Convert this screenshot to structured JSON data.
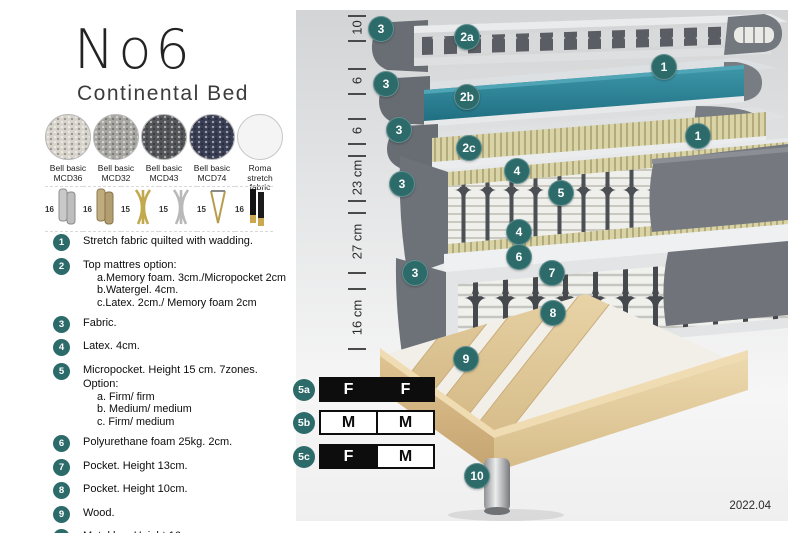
{
  "title": "No6",
  "subtitle": "Continental Bed",
  "accent": "#2d6b6b",
  "fabrics": [
    {
      "name": "Bell basic",
      "code": "MCD36",
      "color": "#d8d4cc"
    },
    {
      "name": "Bell basic",
      "code": "MCD32",
      "color": "#a7a6a1"
    },
    {
      "name": "Bell basic",
      "code": "MCD43",
      "color": "#55565a"
    },
    {
      "name": "Bell basic",
      "code": "MCD74",
      "color": "#3a3e55"
    },
    {
      "name": "Roma",
      "code": "stretch fabric",
      "color": "#f4f4f4"
    }
  ],
  "legs": [
    {
      "height": "16",
      "type": "cylinder-silver"
    },
    {
      "height": "16",
      "type": "cylinder-bronze"
    },
    {
      "height": "15",
      "type": "twist-gold"
    },
    {
      "height": "15",
      "type": "twist-silver"
    },
    {
      "height": "15",
      "type": "hairpin-gold"
    },
    {
      "height": "16",
      "type": "taper-black-gold"
    }
  ],
  "legend": [
    {
      "num": "1",
      "text": "Stretch fabric quilted with wadding.",
      "sub": []
    },
    {
      "num": "2",
      "text": "Top mattres option:",
      "sub": [
        "a.Memory foam. 3cm./Micropocket 2cm",
        "b.Watergel. 4cm.",
        "c.Latex. 2cm./ Memory foam 2cm"
      ]
    },
    {
      "num": "3",
      "text": "Fabric.",
      "sub": []
    },
    {
      "num": "4",
      "text": "Latex. 4cm.",
      "sub": []
    },
    {
      "num": "5",
      "text": "Micropocket. Height 15 cm. 7zones. Option:",
      "sub": [
        "a. Firm/ firm",
        "b. Medium/ medium",
        "c. Firm/ medium"
      ]
    },
    {
      "num": "6",
      "text": "Polyurethane foam 25kg. 2cm.",
      "sub": []
    },
    {
      "num": "7",
      "text": "Pocket. Height 13cm.",
      "sub": []
    },
    {
      "num": "8",
      "text": "Pocket. Height 10cm.",
      "sub": []
    },
    {
      "num": "9",
      "text": "Wood.",
      "sub": []
    },
    {
      "num": "10",
      "text": "Metal leg. Height 16cm.",
      "sub": []
    }
  ],
  "diagram": {
    "version": "2022.04",
    "watergel_color": "#2f8a9d",
    "dimensions": [
      {
        "label": "10",
        "y1": 5,
        "y2": 30
      },
      {
        "label": "6",
        "y1": 58,
        "y2": 83
      },
      {
        "label": "6",
        "y1": 108,
        "y2": 133
      },
      {
        "label": "23 cm",
        "y1": 145,
        "y2": 190
      },
      {
        "label": "27 cm",
        "y1": 202,
        "y2": 262
      },
      {
        "label": "16 cm",
        "y1": 278,
        "y2": 338
      }
    ],
    "badges": [
      {
        "label": "3",
        "x": 85,
        "y": 19
      },
      {
        "label": "2a",
        "x": 171,
        "y": 27
      },
      {
        "label": "1",
        "x": 368,
        "y": 57
      },
      {
        "label": "3",
        "x": 90,
        "y": 74
      },
      {
        "label": "2b",
        "x": 171,
        "y": 87
      },
      {
        "label": "1",
        "x": 402,
        "y": 126
      },
      {
        "label": "3",
        "x": 103,
        "y": 120
      },
      {
        "label": "2c",
        "x": 173,
        "y": 138
      },
      {
        "label": "3",
        "x": 106,
        "y": 174
      },
      {
        "label": "4",
        "x": 221,
        "y": 161
      },
      {
        "label": "5",
        "x": 265,
        "y": 183
      },
      {
        "label": "4",
        "x": 223,
        "y": 222
      },
      {
        "label": "6",
        "x": 223,
        "y": 247
      },
      {
        "label": "3",
        "x": 119,
        "y": 263
      },
      {
        "label": "7",
        "x": 256,
        "y": 263
      },
      {
        "label": "8",
        "x": 257,
        "y": 303
      },
      {
        "label": "9",
        "x": 170,
        "y": 349
      },
      {
        "label": "10",
        "x": 181,
        "y": 466
      }
    ],
    "firmness": [
      {
        "id": "5a",
        "y": 367,
        "badge_y": 368,
        "cells": [
          {
            "label": "F",
            "filled": true
          },
          {
            "label": "F",
            "filled": true
          }
        ]
      },
      {
        "id": "5b",
        "y": 400,
        "badge_y": 401,
        "cells": [
          {
            "label": "M",
            "filled": false
          },
          {
            "label": "M",
            "filled": false
          }
        ]
      },
      {
        "id": "5c",
        "y": 434,
        "badge_y": 435,
        "cells": [
          {
            "label": "F",
            "filled": true
          },
          {
            "label": "M",
            "filled": false
          }
        ]
      }
    ]
  }
}
